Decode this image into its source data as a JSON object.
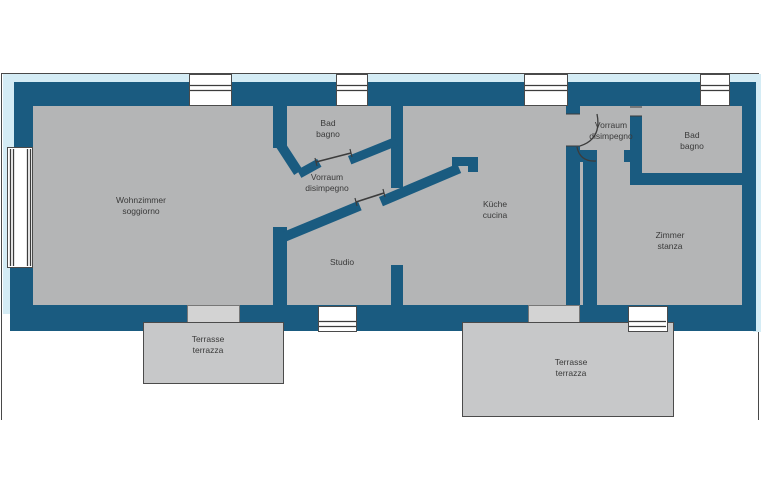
{
  "plan": {
    "type": "apartment-floorplan",
    "language_pair": "de-it",
    "rooms": [
      {
        "id": "wohnzimmer",
        "name_de": "Wohnzimmer",
        "name_it": "soggiorno"
      },
      {
        "id": "bad-left",
        "name_de": "Bad",
        "name_it": "bagno"
      },
      {
        "id": "vorraum-left",
        "name_de": "Vorraum",
        "name_it": "disimpegno"
      },
      {
        "id": "studio",
        "name_de": "Studio",
        "name_it": ""
      },
      {
        "id": "kueche",
        "name_de": "Küche",
        "name_it": "cucina"
      },
      {
        "id": "vorraum-right",
        "name_de": "Vorraum",
        "name_it": "disimpegno"
      },
      {
        "id": "bad-right",
        "name_de": "Bad",
        "name_it": "bagno"
      },
      {
        "id": "zimmer",
        "name_de": "Zimmer",
        "name_it": "stanza"
      },
      {
        "id": "terrasse-left",
        "name_de": "Terrasse",
        "name_it": "terrazza"
      },
      {
        "id": "terrasse-right",
        "name_de": "Terrasse",
        "name_it": "terrazza"
      }
    ],
    "colors": {
      "wall": "#1a5b80",
      "floor": "#b4b5b6",
      "terrace": "#c7c8c9",
      "landing": "#d3d3d3",
      "halo": "#d4ecf5",
      "outline": "#3c3c3c",
      "background": "#ffffff",
      "text": "#3a3a3a"
    }
  }
}
